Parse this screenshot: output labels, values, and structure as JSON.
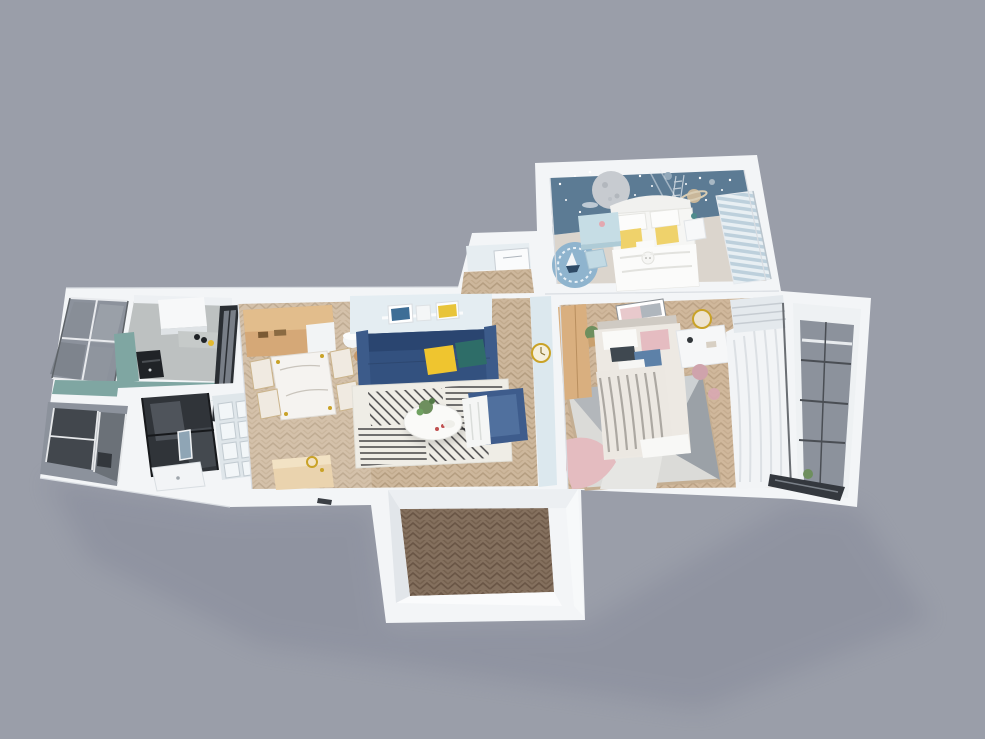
{
  "scene": {
    "type": "3d-floor-plan-render",
    "description": "Top-down 3D cutaway render of a two-bedroom apartment on a gray backdrop",
    "rooms": [
      {
        "name": "kids-bedroom",
        "position": "top-right",
        "features": [
          "space mural wall",
          "white bed with yellow pillows",
          "blue desk",
          "round blue rug",
          "striped blinds"
        ]
      },
      {
        "name": "master-bedroom",
        "position": "right",
        "features": [
          "beige bed with striped throw",
          "geometric gray-pink rug",
          "wood wardrobe",
          "white desk with gold mirror",
          "sheer curtains"
        ]
      },
      {
        "name": "living-room",
        "position": "center",
        "features": [
          "navy sofa",
          "yellow and teal pillows",
          "black-and-white patch rug",
          "round coffee table",
          "blue armchair",
          "picture ledge"
        ]
      },
      {
        "name": "dining-area",
        "position": "center-left",
        "features": [
          "marble dining table",
          "four chairs",
          "wood sideboard"
        ]
      },
      {
        "name": "kitchen",
        "position": "left",
        "features": [
          "teal counters",
          "black oven",
          "white cabinets",
          "concrete floor",
          "glass partition"
        ]
      },
      {
        "name": "bathroom",
        "position": "bottom-left",
        "features": [
          "dark glass shower",
          "white tub",
          "paneled wall"
        ]
      },
      {
        "name": "entrance-hall",
        "position": "bottom-center",
        "features": [
          "dark herringbone floor vestibule"
        ]
      },
      {
        "name": "balcony-left-top",
        "position": "far-left",
        "features": [
          "glazed windows"
        ]
      },
      {
        "name": "balcony-left-bottom",
        "position": "far-left-lower",
        "features": [
          "glazed windows",
          "dark sashes"
        ]
      },
      {
        "name": "balcony-right",
        "position": "far-right",
        "features": [
          "glazed windows"
        ]
      }
    ]
  },
  "colors": {
    "background": "#9A9EA9",
    "shadow": "#6C7085",
    "wall": "#F3F5F7",
    "wall_shade": "#DDE1E6",
    "mural_blue": "#5C7B94",
    "kids_carpet": "#DBD5CD",
    "kids_rug_blue": "#8FB4CE",
    "kids_desk_blue": "#C6DDE5",
    "blind_stripe_blue": "#BDD0DC",
    "sofa_navy": "#33517F",
    "sofa_navy_dark": "#2A4570",
    "pillow_yellow": "#EFC52F",
    "pillow_teal": "#2E6D68",
    "armchair_blue": "#3E5C8C",
    "living_wall_blue": "#E4EDF2",
    "divider_wall_blue": "#DCE8EE",
    "floor_wood": "#CDB79C",
    "floor_wood_stroke": "#B59E81",
    "entry_floor_dark": "#84705E",
    "entry_floor_stroke": "#6A5646",
    "kitchen_floor": "#BDC1C1",
    "counter_teal": "#7FA6A2",
    "sideboard_wood": "#D5A877",
    "wardrobe_wood": "#D9AF7F",
    "console_wood": "#EAD3AE",
    "glass_gray": "#8C929C",
    "glass_dark_pane": "#42474D",
    "frame_dark": "#34383E",
    "shower_glass": "#25292E",
    "oven_black": "#202327",
    "rug_master_base": "#DBDBD8",
    "rug_master_pink": "#E4BCC0",
    "rug_master_gray": "#B3B7BB",
    "bed_beige": "#EDE9E3",
    "pillow_pink": "#E5BCC1",
    "pillow_blue_folded": "#5D81A8",
    "curtain_white": "#F2F4F6",
    "gold": "#C9A227",
    "plant_green": "#6E8F5E",
    "rug_living_base": "#EFEDE6",
    "rug_living_stripe": "#26262A"
  }
}
